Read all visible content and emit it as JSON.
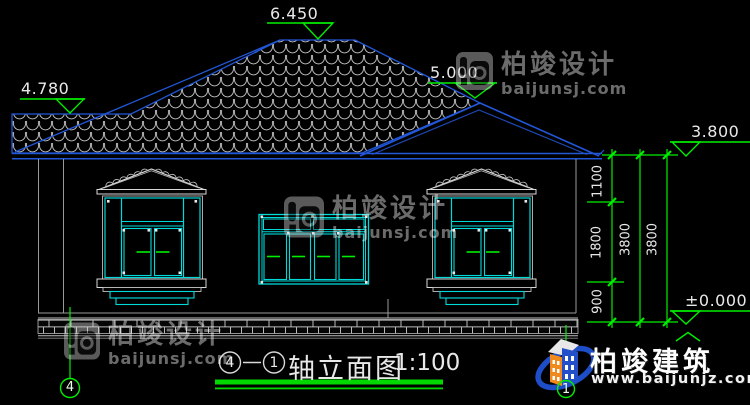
{
  "drawing": {
    "levels": {
      "main_ridge": "6.450",
      "left_ridge": "4.780",
      "porch_ridge": "5.000",
      "eave": "3.800",
      "ground": "±0.000"
    },
    "dims": {
      "seg1": "1100",
      "seg2": "1800",
      "seg3": "900",
      "total1": "3800",
      "total2": "3800"
    },
    "axis_bubbles": {
      "left": "4",
      "right": "1"
    },
    "title": {
      "from": "4",
      "to": "1",
      "name": "轴立面图",
      "scale": "1:100"
    }
  },
  "watermark": {
    "brand": "柏竣设计",
    "domain": "baijunsj.com"
  },
  "brand_logo": {
    "name": "柏竣建筑",
    "url": "www.baijunjz.com"
  },
  "colors": {
    "line_blue": "#2257d8",
    "cad_cyan": "#00d9d9",
    "cad_green": "#00ef00",
    "line_white": "#d9d9d9",
    "logo_orange": "#f08a1e",
    "logo_blue": "#2350c8"
  }
}
